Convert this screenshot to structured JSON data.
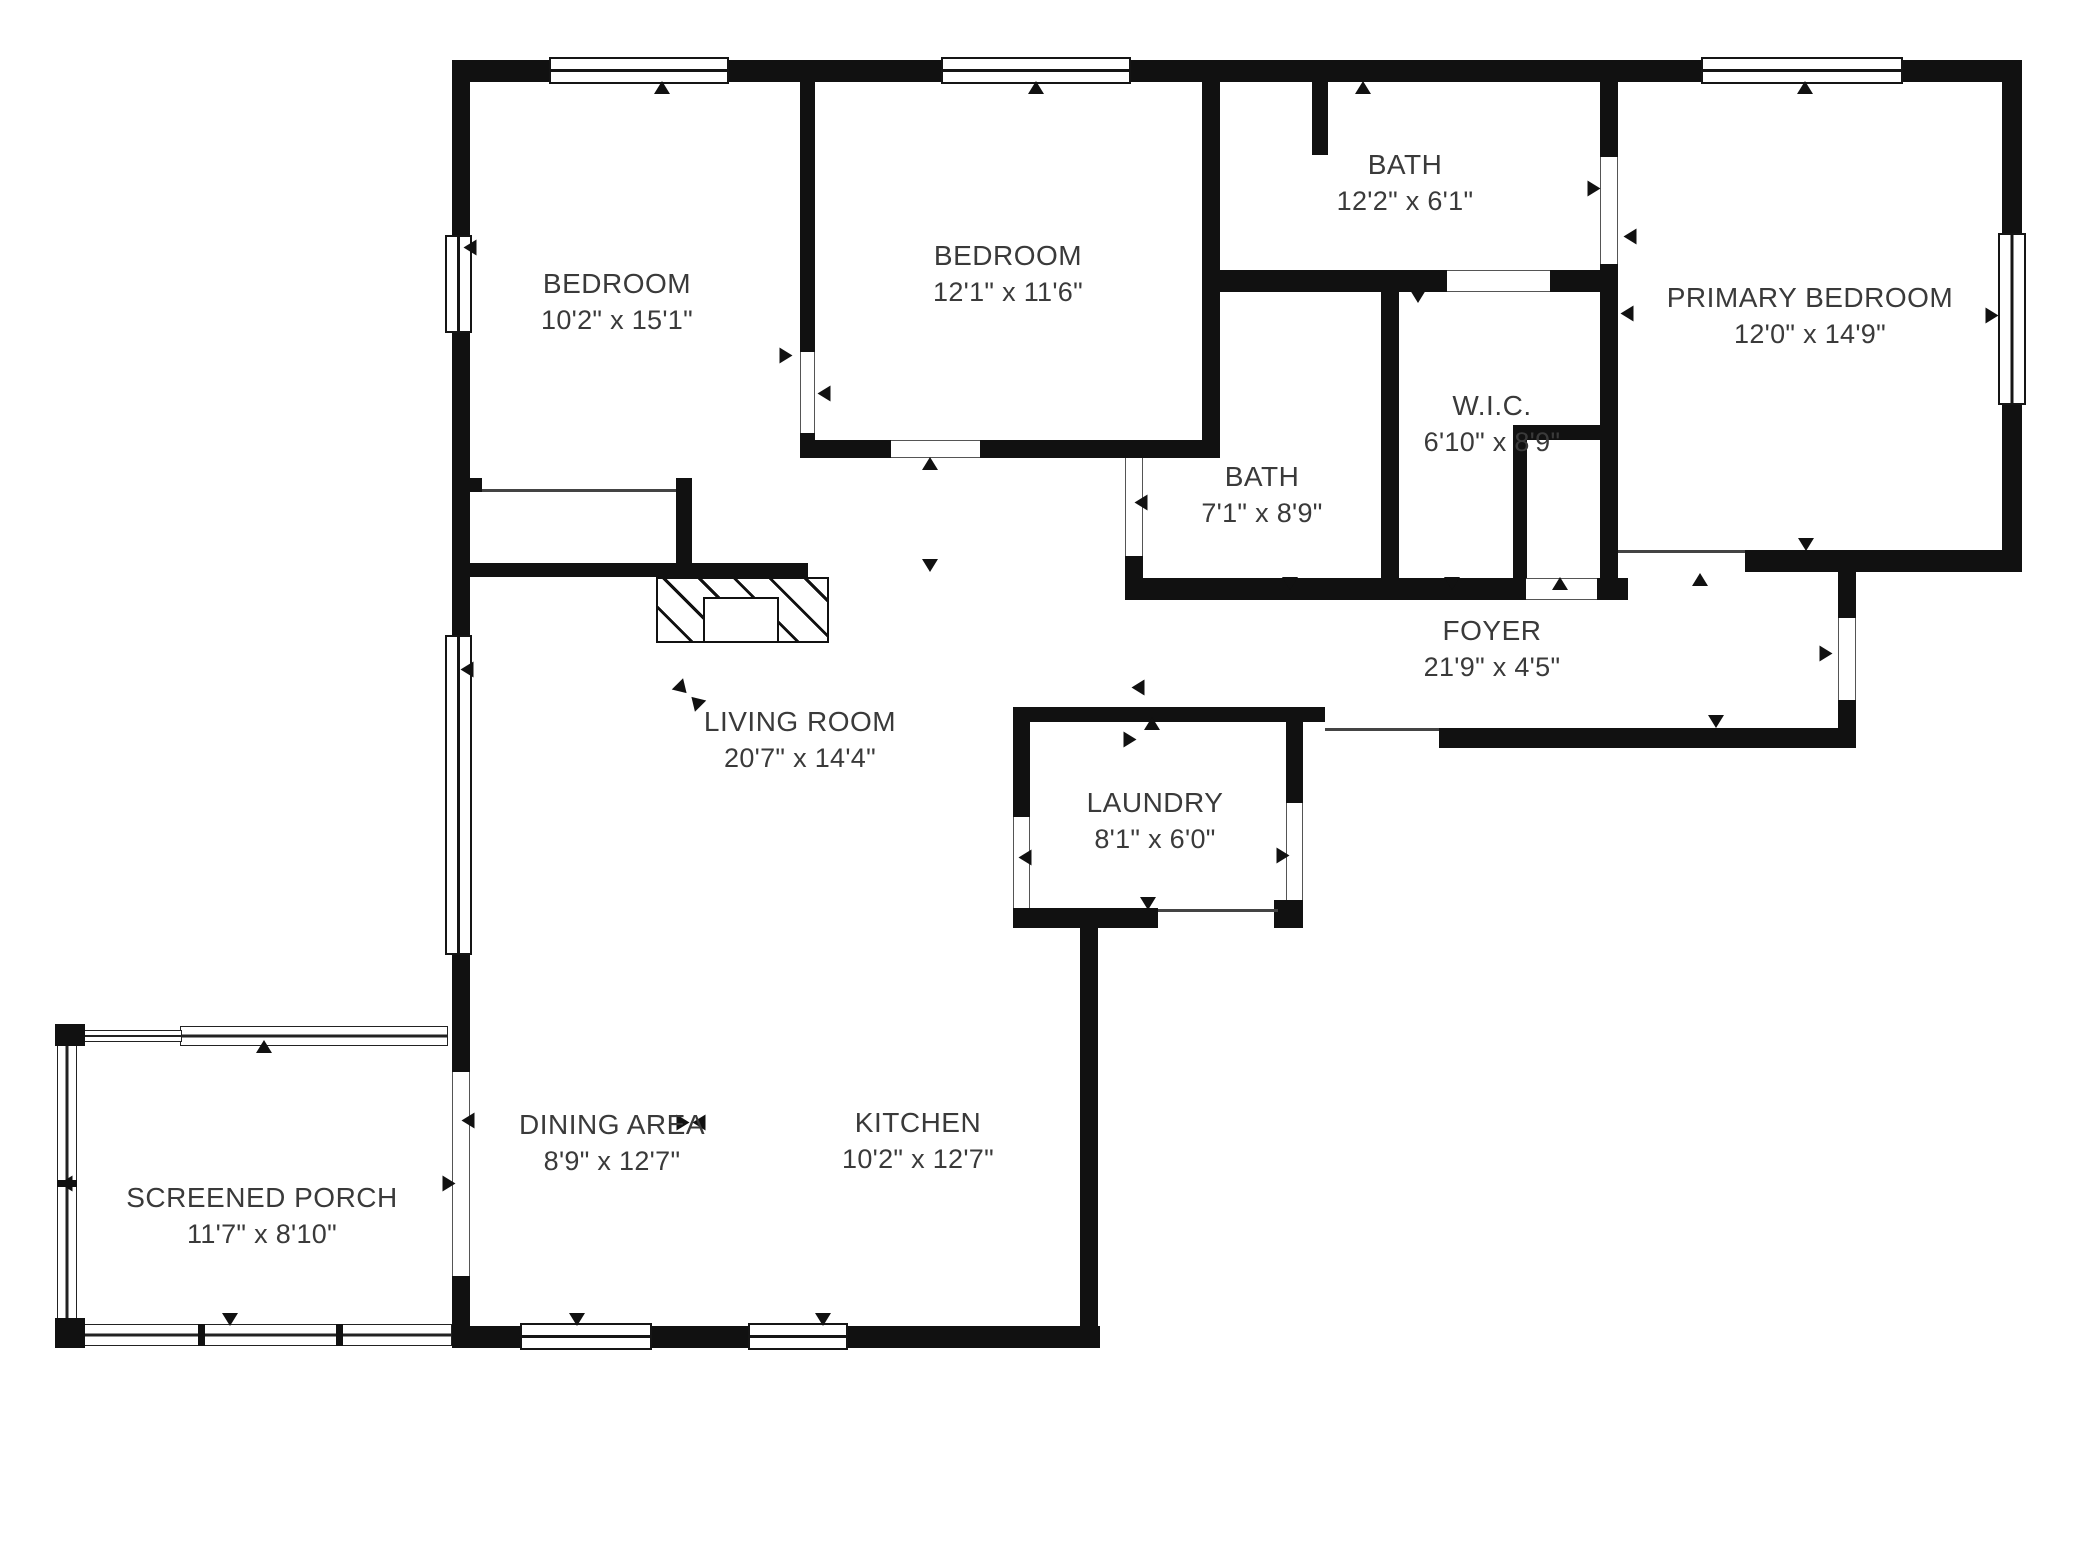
{
  "meta": {
    "type": "residential-floor-plan",
    "bg": "#ffffff",
    "wall_color": "#111111",
    "text_color": "#3a3a3a",
    "width": 2080,
    "height": 1560
  },
  "rooms": [
    {
      "id": "bedroom-1",
      "name": "BEDROOM",
      "dims": "10'2\" x 15'1\"",
      "cx": 617,
      "cy": 302
    },
    {
      "id": "bedroom-2",
      "name": "BEDROOM",
      "dims": "12'1\" x 11'6\"",
      "cx": 1008,
      "cy": 274
    },
    {
      "id": "primary-bedroom",
      "name": "PRIMARY BEDROOM",
      "dims": "12'0\" x 14'9\"",
      "cx": 1810,
      "cy": 316
    },
    {
      "id": "bath-main",
      "name": "BATH",
      "dims": "12'2\" x 6'1\"",
      "cx": 1405,
      "cy": 183
    },
    {
      "id": "wic",
      "name": "W.I.C.",
      "dims": "6'10\" x 8'9\"",
      "cx": 1492,
      "cy": 424
    },
    {
      "id": "bath-hall",
      "name": "BATH",
      "dims": "7'1\" x 8'9\"",
      "cx": 1262,
      "cy": 495
    },
    {
      "id": "foyer",
      "name": "FOYER",
      "dims": "21'9\" x 4'5\"",
      "cx": 1492,
      "cy": 649
    },
    {
      "id": "living-room",
      "name": "LIVING ROOM",
      "dims": "20'7\" x 14'4\"",
      "cx": 800,
      "cy": 740
    },
    {
      "id": "laundry",
      "name": "LAUNDRY",
      "dims": "8'1\" x 6'0\"",
      "cx": 1155,
      "cy": 821
    },
    {
      "id": "dining-area",
      "name": "DINING AREA",
      "dims": "8'9\" x 12'7\"",
      "cx": 612,
      "cy": 1143
    },
    {
      "id": "kitchen",
      "name": "KITCHEN",
      "dims": "10'2\" x 12'7\"",
      "cx": 918,
      "cy": 1141
    },
    {
      "id": "screened-porch",
      "name": "SCREENED PORCH",
      "dims": "11'7\" x 8'10\"",
      "cx": 262,
      "cy": 1216
    }
  ],
  "walls": [
    [
      452,
      60,
      106,
      22
    ],
    [
      726,
      60,
      220,
      22
    ],
    [
      1128,
      60,
      578,
      22
    ],
    [
      1900,
      60,
      122,
      22
    ],
    [
      452,
      60,
      18,
      180
    ],
    [
      452,
      330,
      18,
      310
    ],
    [
      452,
      952,
      18,
      122
    ],
    [
      452,
      1276,
      18,
      72
    ],
    [
      2002,
      60,
      20,
      177
    ],
    [
      2002,
      403,
      20,
      169
    ],
    [
      452,
      1326,
      74,
      22
    ],
    [
      650,
      1326,
      104,
      22
    ],
    [
      846,
      1326,
      254,
      22
    ],
    [
      800,
      82,
      15,
      270
    ],
    [
      800,
      433,
      15,
      25
    ],
    [
      800,
      440,
      91,
      18
    ],
    [
      980,
      440,
      238,
      18
    ],
    [
      452,
      563,
      356,
      14
    ],
    [
      466,
      478,
      16,
      14
    ],
    [
      676,
      478,
      16,
      99
    ],
    [
      1202,
      82,
      18,
      376
    ],
    [
      1312,
      82,
      16,
      73
    ],
    [
      1202,
      270,
      245,
      22
    ],
    [
      1550,
      270,
      68,
      22
    ],
    [
      1600,
      82,
      18,
      75
    ],
    [
      1600,
      264,
      18,
      336
    ],
    [
      1125,
      556,
      18,
      44
    ],
    [
      1381,
      292,
      18,
      286
    ],
    [
      1513,
      425,
      105,
      15
    ],
    [
      1513,
      440,
      14,
      138
    ],
    [
      1133,
      578,
      393,
      22
    ],
    [
      1597,
      578,
      31,
      22
    ],
    [
      1745,
      550,
      277,
      22
    ],
    [
      1838,
      572,
      18,
      46
    ],
    [
      1838,
      700,
      18,
      48
    ],
    [
      1439,
      728,
      417,
      20
    ],
    [
      1013,
      707,
      312,
      15
    ],
    [
      1013,
      722,
      17,
      95
    ],
    [
      1013,
      908,
      145,
      20
    ],
    [
      1274,
      900,
      29,
      28
    ],
    [
      1286,
      722,
      17,
      81
    ],
    [
      1080,
      908,
      18,
      440
    ]
  ],
  "windows": [
    {
      "x": 549,
      "y": 57,
      "w": 180,
      "h": 27,
      "o": "h"
    },
    {
      "x": 941,
      "y": 57,
      "w": 190,
      "h": 27,
      "o": "h"
    },
    {
      "x": 1701,
      "y": 57,
      "w": 202,
      "h": 27,
      "o": "h"
    },
    {
      "x": 445,
      "y": 235,
      "w": 27,
      "h": 98,
      "o": "v"
    },
    {
      "x": 445,
      "y": 635,
      "w": 27,
      "h": 320,
      "o": "v"
    },
    {
      "x": 1998,
      "y": 233,
      "w": 28,
      "h": 172,
      "o": "v"
    },
    {
      "x": 520,
      "y": 1323,
      "w": 132,
      "h": 27,
      "o": "h"
    },
    {
      "x": 748,
      "y": 1323,
      "w": 100,
      "h": 27,
      "o": "h"
    }
  ],
  "porch": {
    "rails": [
      {
        "x": 180,
        "y": 1026,
        "w": 268,
        "h": 20,
        "o": "h"
      },
      {
        "x": 83,
        "y": 1030,
        "w": 99,
        "h": 12,
        "o": "h"
      },
      {
        "x": 57,
        "y": 1044,
        "w": 20,
        "h": 276,
        "o": "v"
      },
      {
        "x": 81,
        "y": 1324,
        "w": 371,
        "h": 22,
        "o": "h"
      }
    ],
    "posts": [
      [
        55,
        1024,
        30,
        22
      ],
      [
        55,
        1318,
        30,
        30
      ]
    ],
    "ticks": [
      [
        57,
        1180,
        20,
        7
      ],
      [
        198,
        1324,
        7,
        22
      ],
      [
        336,
        1324,
        7,
        22
      ]
    ]
  },
  "gaps": [
    {
      "x": 452,
      "y": 1072,
      "w": 18,
      "h": 204,
      "o": "v"
    },
    {
      "x": 800,
      "y": 352,
      "w": 15,
      "h": 81,
      "o": "v"
    },
    {
      "x": 891,
      "y": 440,
      "w": 89,
      "h": 18,
      "o": "h"
    },
    {
      "x": 1125,
      "y": 458,
      "w": 18,
      "h": 98,
      "o": "v"
    },
    {
      "x": 1600,
      "y": 157,
      "w": 18,
      "h": 107,
      "o": "v"
    },
    {
      "x": 1447,
      "y": 270,
      "w": 103,
      "h": 22,
      "o": "h"
    },
    {
      "x": 1526,
      "y": 578,
      "w": 71,
      "h": 22,
      "o": "h"
    },
    {
      "x": 1838,
      "y": 618,
      "w": 18,
      "h": 82,
      "o": "v"
    },
    {
      "x": 1013,
      "y": 817,
      "w": 17,
      "h": 91,
      "o": "v"
    },
    {
      "x": 1286,
      "y": 803,
      "w": 17,
      "h": 97,
      "o": "v"
    }
  ],
  "thin_lines": [
    [
      482,
      489,
      194,
      3
    ],
    [
      1618,
      550,
      127,
      3
    ],
    [
      1325,
      728,
      114,
      3
    ],
    [
      1158,
      909,
      120,
      3
    ]
  ],
  "fireplace": {
    "outer": [
      656,
      577,
      173,
      66
    ],
    "inner": [
      703,
      597,
      76,
      46
    ]
  },
  "markers": [
    {
      "x": 662,
      "y": 88,
      "r": 0
    },
    {
      "x": 1036,
      "y": 88,
      "r": 0
    },
    {
      "x": 1363,
      "y": 88,
      "r": 0
    },
    {
      "x": 1805,
      "y": 88,
      "r": 0
    },
    {
      "x": 470,
      "y": 248,
      "r": 270
    },
    {
      "x": 467,
      "y": 670,
      "r": 270
    },
    {
      "x": 786,
      "y": 356,
      "r": 90
    },
    {
      "x": 824,
      "y": 394,
      "r": 270
    },
    {
      "x": 930,
      "y": 464,
      "r": 0
    },
    {
      "x": 1141,
      "y": 503,
      "r": 270
    },
    {
      "x": 1418,
      "y": 297,
      "r": 180
    },
    {
      "x": 1594,
      "y": 189,
      "r": 90
    },
    {
      "x": 1630,
      "y": 237,
      "r": 270
    },
    {
      "x": 1290,
      "y": 584,
      "r": 180
    },
    {
      "x": 1452,
      "y": 584,
      "r": 180
    },
    {
      "x": 1560,
      "y": 584,
      "r": 0
    },
    {
      "x": 1700,
      "y": 580,
      "r": 0
    },
    {
      "x": 1806,
      "y": 545,
      "r": 180
    },
    {
      "x": 930,
      "y": 566,
      "r": 180
    },
    {
      "x": 1138,
      "y": 688,
      "r": 270
    },
    {
      "x": 1130,
      "y": 740,
      "r": 90
    },
    {
      "x": 1826,
      "y": 654,
      "r": 90
    },
    {
      "x": 1716,
      "y": 722,
      "r": 180
    },
    {
      "x": 1152,
      "y": 724,
      "r": 0
    },
    {
      "x": 1025,
      "y": 858,
      "r": 270
    },
    {
      "x": 1283,
      "y": 856,
      "r": 90
    },
    {
      "x": 1148,
      "y": 904,
      "r": 180
    },
    {
      "x": 264,
      "y": 1047,
      "r": 0
    },
    {
      "x": 66,
      "y": 1184,
      "r": 270
    },
    {
      "x": 230,
      "y": 1320,
      "r": 180
    },
    {
      "x": 468,
      "y": 1121,
      "r": 270
    },
    {
      "x": 449,
      "y": 1184,
      "r": 90
    },
    {
      "x": 683,
      "y": 1123,
      "r": 90
    },
    {
      "x": 699,
      "y": 1123,
      "r": 270
    },
    {
      "x": 577,
      "y": 1320,
      "r": 180
    },
    {
      "x": 823,
      "y": 1320,
      "r": 180
    },
    {
      "x": 1992,
      "y": 316,
      "r": 90
    },
    {
      "x": 1627,
      "y": 314,
      "r": 270
    },
    {
      "x": 682,
      "y": 689,
      "r": 135
    },
    {
      "x": 696,
      "y": 702,
      "r": 315
    }
  ]
}
